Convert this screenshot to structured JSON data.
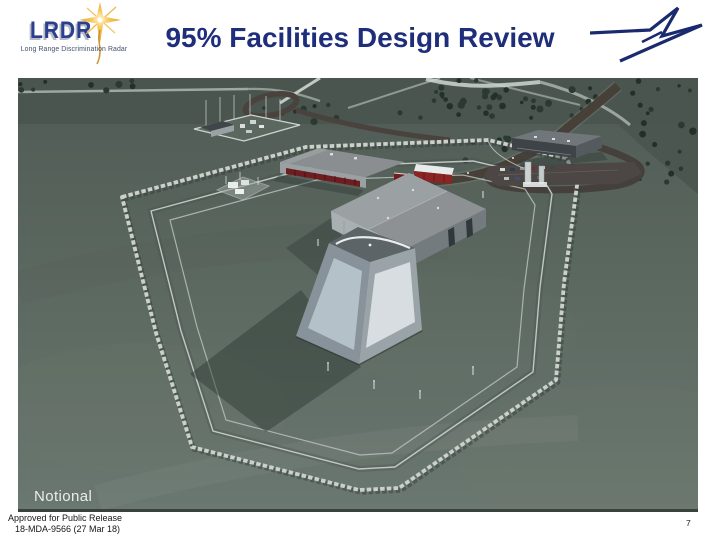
{
  "slide": {
    "title": "95% Facilities Design Review",
    "page_number": "7",
    "approval_line1": "Approved for Public Release",
    "approval_line2": "18-MDA-9566 (27 Mar 18)"
  },
  "lrdr_logo": {
    "acronym": "LRDR",
    "tagline": "Long Range Discrimination Radar"
  },
  "render": {
    "caption": "Notional",
    "alt": "Aerial 3D rendering of the LRDR radar site: central truncated-pyramid radar array building attached to a gable-roof equipment building, long storage building with red loading bays, electrical substation, transformer pad, entry control point, support building with parking lot, access roads, double security fence and an octagonal concrete-block perimeter in a tree-lined clearing"
  },
  "colors": {
    "title-navy": "#1f2e7b",
    "logo-blue": "#2b3f8f",
    "logo-gold": "#efa92f",
    "lm-navy": "#1a2a6e",
    "field-green": "#5d6a63",
    "field-dark": "#49554e",
    "tree-green": "#25322b",
    "road-brown": "#474038",
    "barrier-gray": "#cbd0cb",
    "building-gray": "#8e9193",
    "array-panel-light": "#d7dde1",
    "bay-red": "#6e1d20",
    "caption-gray": "#e9edeb",
    "footer-black": "#161616"
  }
}
